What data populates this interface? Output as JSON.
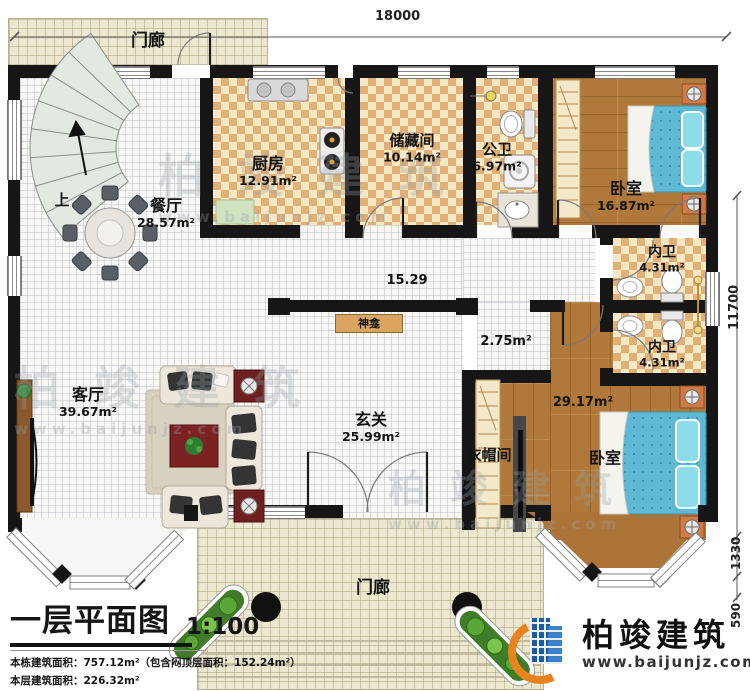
{
  "dimensions": {
    "top_width": "18000",
    "right_height": "11700",
    "bay_depth": "1330",
    "bay_step": "590"
  },
  "labels": {
    "hall_width": "15.29",
    "small_area": "2.75m²",
    "suite_area": "29.17m²",
    "stairs_up": "上"
  },
  "rooms": {
    "porch_top": {
      "name": "门廊"
    },
    "porch_bottom": {
      "name": "门廊"
    },
    "dining": {
      "name": "餐厅",
      "area": "28.57m²"
    },
    "kitchen": {
      "name": "厨房",
      "area": "12.91m²"
    },
    "storage": {
      "name": "储藏间",
      "area": "10.14m²"
    },
    "public_bath": {
      "name": "公卫",
      "area": "6.97m²"
    },
    "bedroom_top": {
      "name": "卧室",
      "area": "16.87m²"
    },
    "inner_bath_1": {
      "name": "内卫",
      "area": "4.31m²"
    },
    "inner_bath_2": {
      "name": "内卫",
      "area": "4.31m²"
    },
    "foyer": {
      "name": "玄关",
      "area": "25.99m²"
    },
    "living": {
      "name": "客厅",
      "area": "39.67m²"
    },
    "shrine": {
      "name": "神龛"
    },
    "cloakroom": {
      "name": "衣帽间"
    },
    "bedroom_bottom": {
      "name": "卧室"
    }
  },
  "title_block": {
    "title": "一层平面图",
    "scale": "1:100",
    "line1": "本栋建筑面积：757.12m²（包含闷顶层面积：152.24m²）",
    "line2": "本层建筑面积：226.32m²",
    "line3": "建筑占地面积：226.32m²",
    "line3b": "层高：3.6m"
  },
  "brand": {
    "name": "柏竣建筑",
    "url": "www.baijunjz.com"
  },
  "watermark": {
    "name": "柏竣建筑",
    "url": "www.baijunjz.com"
  }
}
